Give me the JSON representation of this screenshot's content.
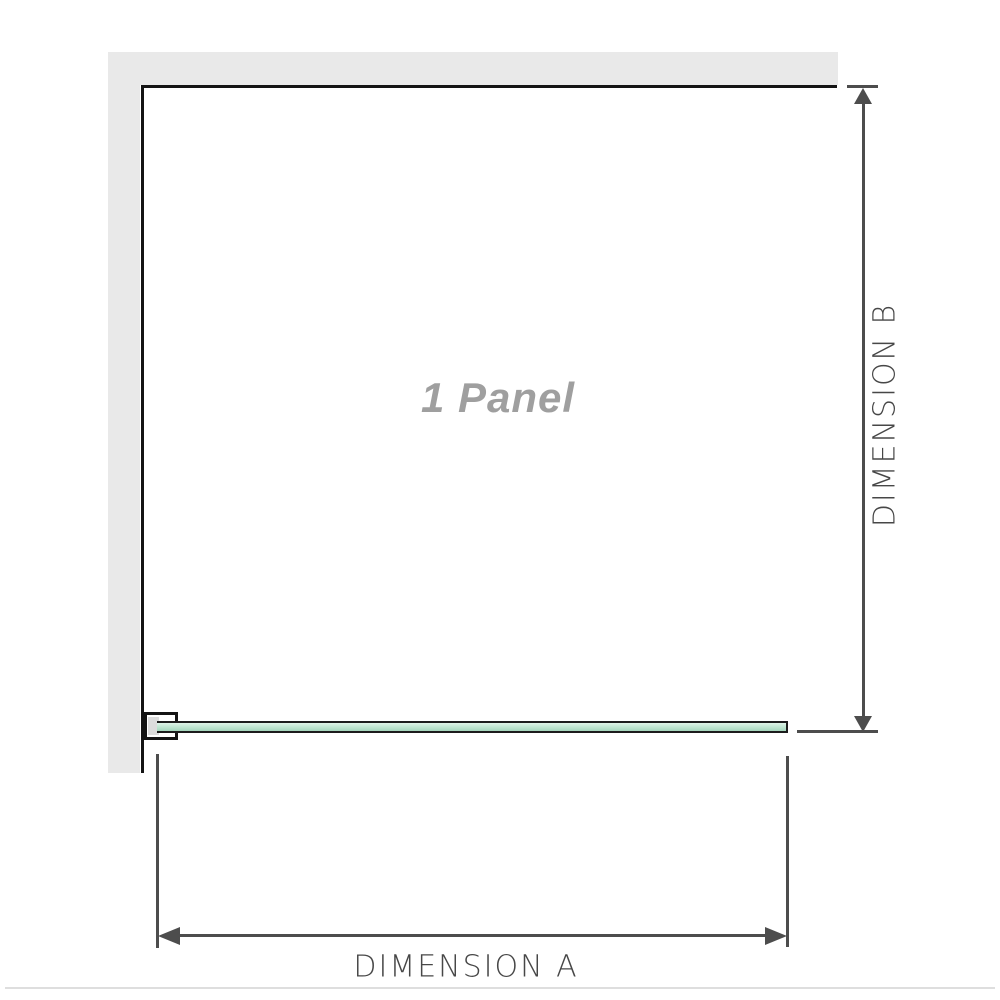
{
  "diagram": {
    "panel_label": "1 Panel",
    "dimension_a_label": "DIMENSION A",
    "dimension_b_label": "DIMENSION B"
  },
  "icons": {
    "arrow_up": "triangle-up",
    "arrow_down": "triangle-down",
    "arrow_left": "triangle-left",
    "arrow_right": "triangle-right"
  },
  "colors": {
    "background": "#ffffff",
    "wall": "#e9e9e9",
    "wall_edge": "#141414",
    "glass_border": "#1c1c1c",
    "glass_green_light": "#dff2e8",
    "glass_green_dark": "#a3d5bc",
    "bracket_fill": "#dcdcdc",
    "dimension_line": "#4d4d4d",
    "dimension_text": "#474747",
    "panel_label_color": "#9f9f9f",
    "separator": "#dedede"
  }
}
